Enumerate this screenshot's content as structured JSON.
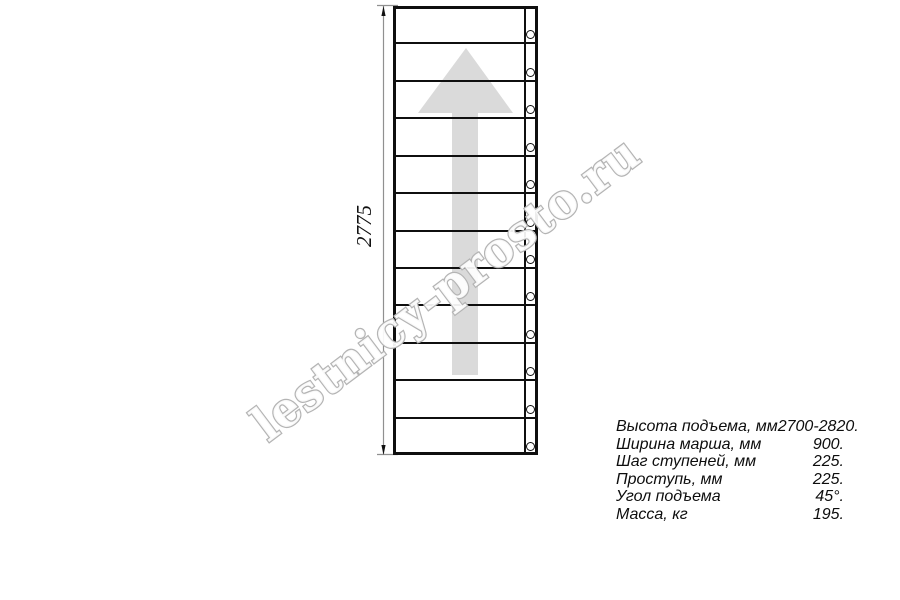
{
  "drawing": {
    "watermark": "lestnicy-prosto.ru",
    "dimension_label": "2775",
    "steps_count": 12
  },
  "specs": [
    {
      "label": "Высота подъема, мм",
      "value": "2700-2820."
    },
    {
      "label": "Ширина марша, мм",
      "value": "900."
    },
    {
      "label": "Шаг ступеней, мм",
      "value": "225."
    },
    {
      "label": "Проступь, мм",
      "value": "225."
    },
    {
      "label": "Угол подъема",
      "value": "45°."
    },
    {
      "label": "Масса, кг",
      "value": "195."
    }
  ],
  "colors": {
    "line": "#0f0f0f",
    "arrow_fill": "#dadada",
    "watermark_stroke": "#b4b4b4",
    "dim_line": "#909090"
  }
}
